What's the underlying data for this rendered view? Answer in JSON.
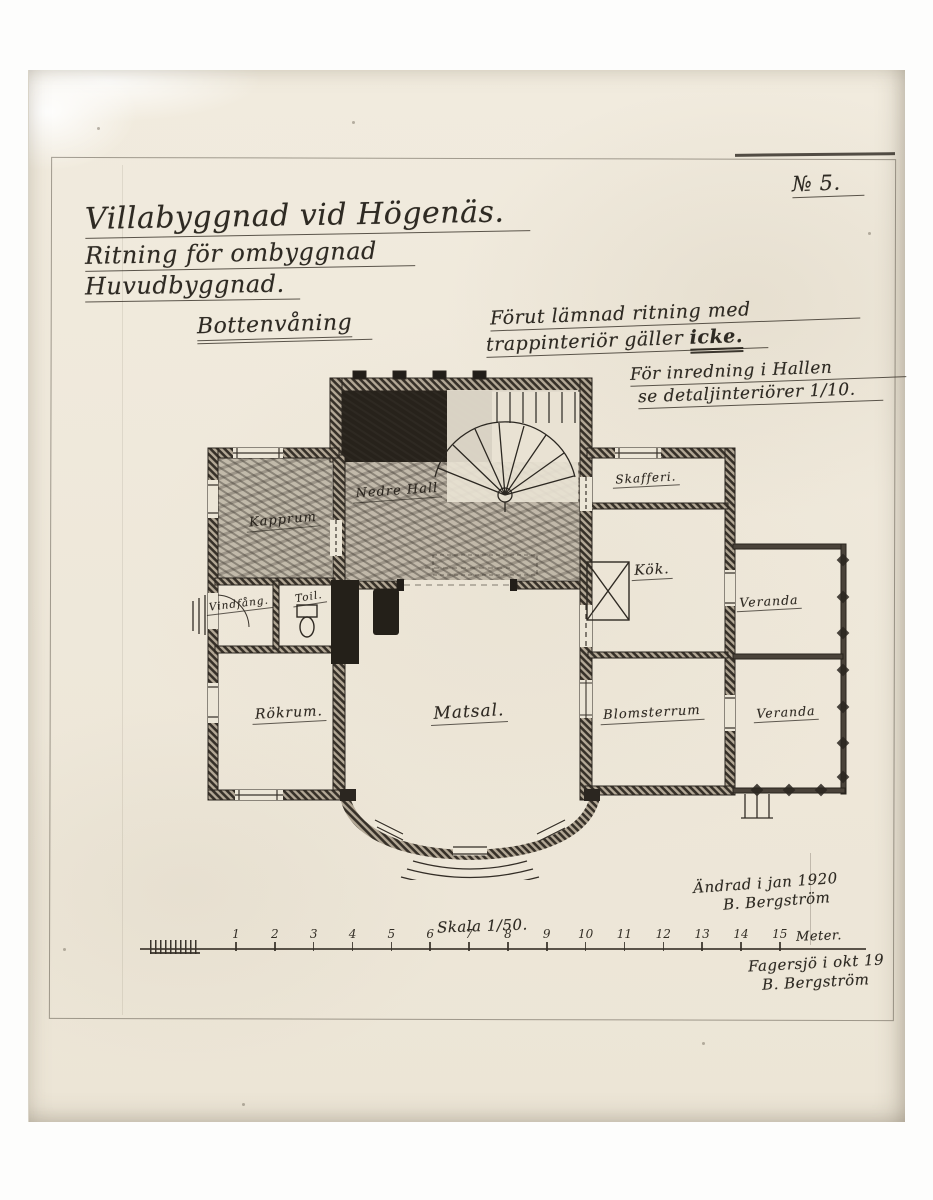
{
  "drawing_number": "№ 5.",
  "title": {
    "line1": "Villabyggnad vid Högenäs.",
    "line2": "Ritning för ombyggnad",
    "line3": "Huvudbyggnad."
  },
  "floor_label": "Bottenvåning",
  "notes": {
    "stair_note": {
      "line1": "Förut lämnad ritning med",
      "line2_pre": "trappinteriör gäller ",
      "line2_emph": "icke."
    },
    "hall_note": {
      "line1": "För inredning i Hallen",
      "line2": "se detaljinteriörer 1/10."
    }
  },
  "plan": {
    "rooms": [
      {
        "id": "kapprum",
        "label": "Kapprum"
      },
      {
        "id": "nedre-hall",
        "label": "Nedre Hall"
      },
      {
        "id": "skafferi",
        "label": "Skafferi."
      },
      {
        "id": "kok",
        "label": "Kök."
      },
      {
        "id": "veranda-ovre",
        "label": "Veranda"
      },
      {
        "id": "vindfang",
        "label": "Vindfång."
      },
      {
        "id": "toil",
        "label": "Toil."
      },
      {
        "id": "rokrum",
        "label": "Rökrum."
      },
      {
        "id": "matsal",
        "label": "Matsal."
      },
      {
        "id": "blomsterrum",
        "label": "Blomsterrum"
      },
      {
        "id": "veranda-nedre",
        "label": "Veranda"
      }
    ]
  },
  "scale": {
    "label": "Skala 1/50.",
    "numbers": [
      "1",
      "2",
      "3",
      "4",
      "5",
      "6",
      "7",
      "8",
      "9",
      "10",
      "11",
      "12",
      "13",
      "14",
      "15"
    ],
    "unit": "Meter."
  },
  "revision_signature": {
    "line1": "Ändrad i jan 1920",
    "line2": "B. Bergström"
  },
  "footer_signature": {
    "line1": "Fagersjö i okt 19",
    "line2": "B. Bergström"
  },
  "colors": {
    "paper": "#efe9dc",
    "pencil": "#2e2a23"
  }
}
